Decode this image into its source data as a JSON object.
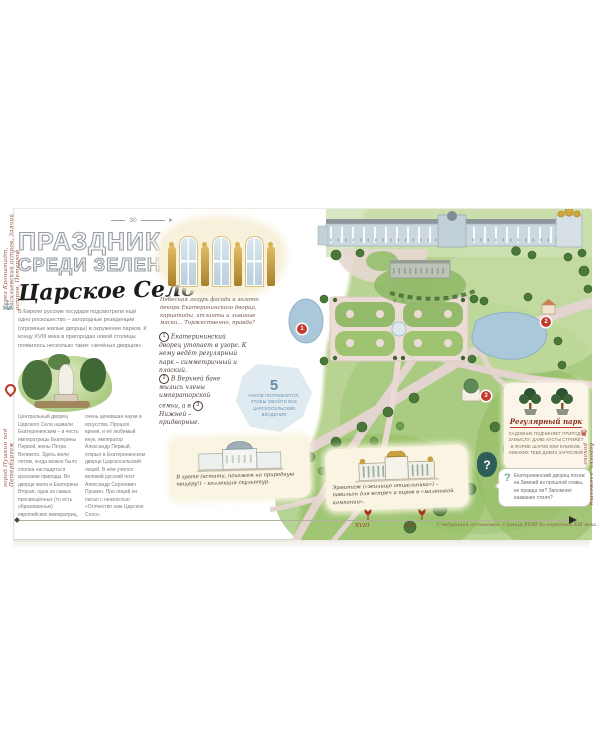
{
  "page": {
    "number": "30",
    "title": {
      "line1": "ПРАЗДНИК",
      "line2": "СРЕДИ ЗЕЛЕНИ",
      "subtitle": "Царское Село"
    },
    "intro": "В Европе русские государи подсмотрели ещё одно роскошество – загородные резиденции (огромные жилые дворцы) в окружении парков. К концу XVIII века в пригородах новой столицы появилось несколько таких «зелёных дворцов».",
    "facade_caption": "Небесная лазурь фасада и золото декора Екатерининского дворца, кариатиды, атланты и львиные маски... Торжественно, правда?",
    "notes": {
      "n1_num": "1",
      "n1_text": "Екатерининский дворец утопает в узоре. К нему ведёт регулярный парк – симметричный и плоский.",
      "n2_num": "2",
      "n2_text_a": "В Верхней бане мылись члены императорской семьи, а в",
      "n3_num": "3",
      "n2_text_b": "Нижней – придворные."
    },
    "stat": {
      "value": "5",
      "label": "часов потребуется, чтобы обойти все царскосельские владения"
    },
    "history_col1": "Центральный дворец Царского Села назвали Екатерининским – в честь императрицы Екатерины Первой, жены Петра Великого. Здесь жили летом, когда можно было сполна насладиться красками природы. Во дворце жила и Екатерина Вторая, одна из самых просвещённых (то есть образованных) европейских императриц,",
    "history_col2": "очень ценившая науки и искусства. Прошло время, и её любимый внук, император Александр Первый, открыл в Екатерининском дворце Царскосельский лицей. В нём учился великий русский поэт Александр Сергеевич Пушкин. Про лицей он писал с нежностью: «Отечество нам Царское Село».",
    "grotto_caption": "В гроте (кстати, похожем на природную пещеру!) – коллекция скульптур.",
    "hermitage_caption": "Эрмитаж («жилище отшельника») – павильон для встреч и пиров в «маленькой компании».",
    "park_box": {
      "title": "Регулярный парк",
      "text": "Садовник подчиняет природу замыслу: даже кусты стрижёт в форме шаров или кубиков. Никаких тебе диких зарослей!"
    },
    "question": {
      "mark": "?",
      "text": "Екатерининский дворец похож на Зимний из прошлой главы, не правда ли? Запомнил название стиля?"
    },
    "timeline": {
      "era_start": "XVIII",
      "era_end": "XIX",
      "note": "Следующая остановка: с конца XVIII до середины XIX века"
    },
    "margins": {
      "route": "Через Кронштадт, Васильевский остров, Заячий остров, Петергоф",
      "location": "город Пушкин под Петербургом",
      "style": "барокко, элементы рококо",
      "anchor_icon": "⚓",
      "crown_icon": "♛"
    },
    "map": {
      "marker1": "1",
      "marker2": "2",
      "marker3": "3"
    }
  },
  "colors": {
    "accent_red": "#c23b2e",
    "park_green": "#a9c87c",
    "pond_blue": "#abc8da",
    "stat_blue": "#dde9f1",
    "card_cream": "#faf4e3"
  }
}
